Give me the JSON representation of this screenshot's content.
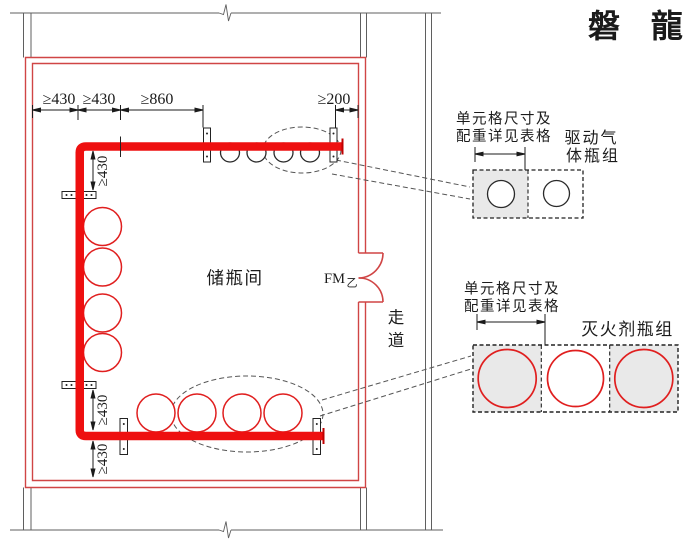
{
  "watermark": "磐 龍",
  "labels": {
    "room": "储瓶间",
    "door": "FM",
    "door_class": "乙",
    "corridor": [
      "走",
      "道"
    ]
  },
  "dims": {
    "top": [
      "≥430",
      "≥430",
      "≥860",
      "≥200"
    ],
    "side": [
      "≥430",
      "≥430",
      "≥430"
    ]
  },
  "notes": {
    "cell_note_line1": "单元格尺寸及",
    "cell_note_line2": "配重详见表格",
    "driver_group_line1": "驱动气",
    "driver_group_line2": "体瓶组",
    "agent_group": "灭火剂瓶组"
  },
  "colors": {
    "pipe_red": "#ee1010",
    "wall_red": "#d04545",
    "bottle_red": "#e01f1f",
    "line_gray": "#5f5f5f",
    "cell_gray": "#e9e9e9",
    "watermark_pink": "#ede5e9"
  }
}
